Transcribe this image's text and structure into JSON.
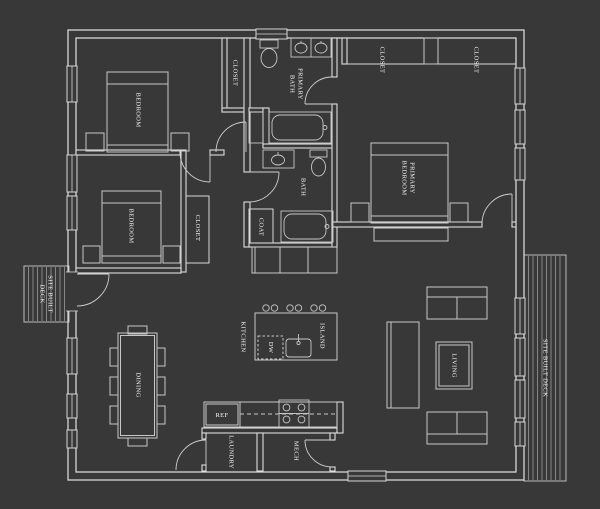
{
  "plan": {
    "rooms": {
      "bedroom_top": "BEDROOM",
      "bedroom_middle": "BEDROOM",
      "closet_bedroom_top": "CLOSET",
      "closet_bedroom_middle": "CLOSET",
      "primary_bath": [
        "PRIMARY",
        "BATH"
      ],
      "bath": "BATH",
      "coat": "COAT",
      "primary_closet_left": "CLOSET",
      "primary_closet_right": "CLOSET",
      "primary_bedroom": [
        "PRIMARY",
        "BEDROOM"
      ],
      "kitchen": "KITCHEN",
      "island": "ISLAND",
      "dishwasher": "DW",
      "refrigerator": "REF",
      "dining": "DINING",
      "living": "LIVING",
      "laundry": "LAUNDRY",
      "mech": "MECH",
      "deck_left": [
        "SITE BUILT",
        "DECK"
      ],
      "deck_right": "SITE BUILT DECK"
    },
    "colors": {
      "background": "#383838",
      "walls": "#dedede",
      "furniture": "#c7c7c7",
      "deck_planks": "#999999",
      "label_text": "#f5f5f5"
    }
  }
}
